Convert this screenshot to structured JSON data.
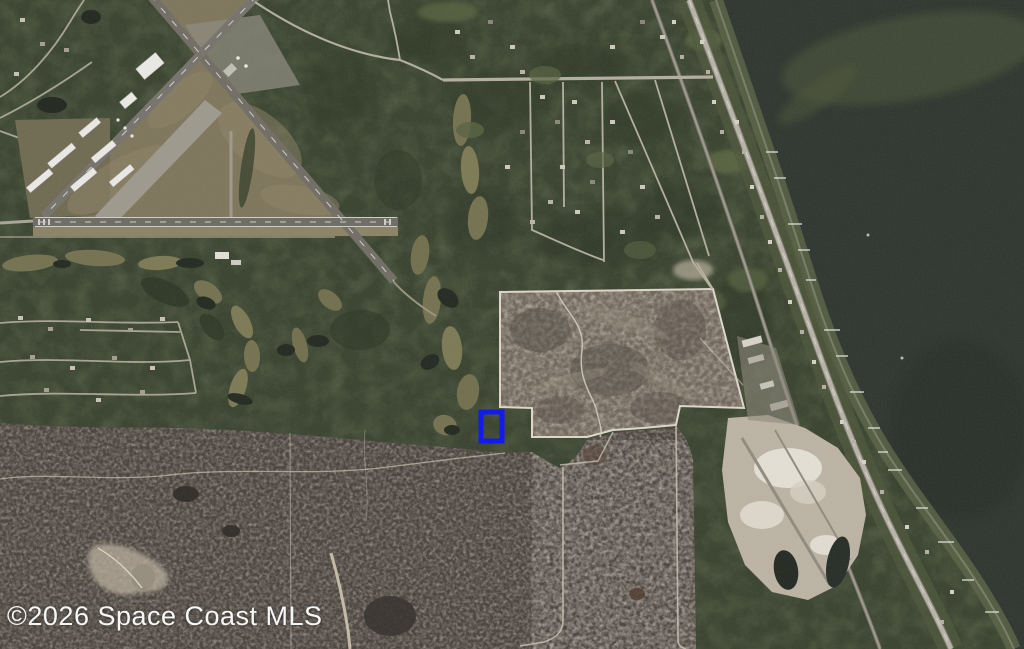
{
  "map": {
    "watermark": "©2026 Space Coast MLS",
    "imagery_type": "satellite-aerial-photo",
    "marker": {
      "x": "481",
      "y": "412",
      "width": "21",
      "height": "29",
      "color": "#0712ee",
      "meaning": "subject-property-location"
    },
    "palette": {
      "water": "#2b332c",
      "woods": "#36402c",
      "scrub": "#47403a",
      "cleared_parcel": "#6e6458",
      "runway": "#6f6b62",
      "road": "#b6b2a7",
      "trail_white": "#d6d0c2",
      "quarry_sand": "#bcb3a3",
      "hangar_white": "#eceae6",
      "watermark_text": "#ffffff"
    },
    "features": {
      "airport": "airport-with-crossing-runways",
      "water_body": "lagoon",
      "parcel": "cleared-scrub-parcel-with-white-boundary-trails",
      "quarry": "sand-pit",
      "corridor": "railroad-and-highway-along-shore"
    }
  }
}
